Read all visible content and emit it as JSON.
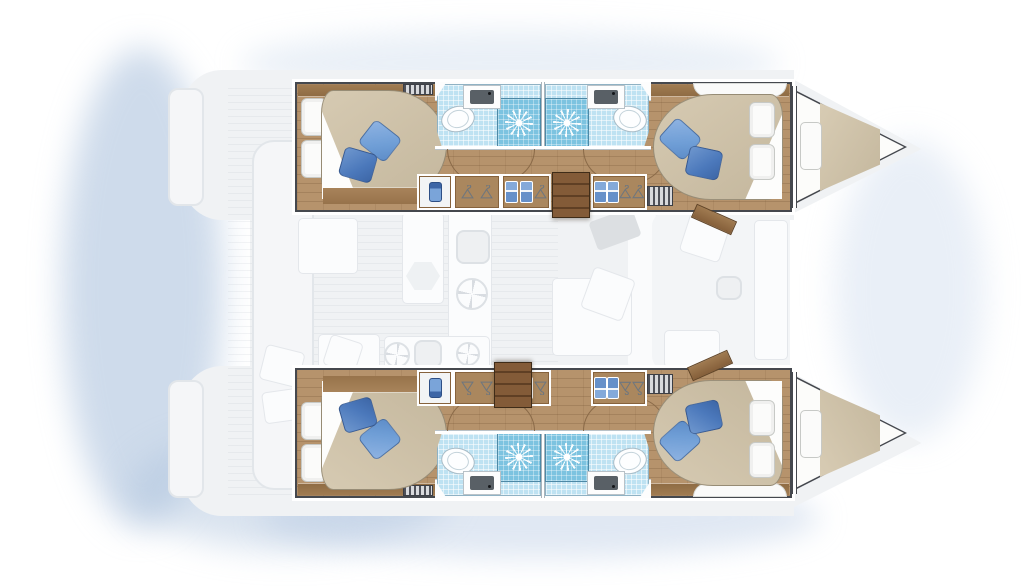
{
  "meta": {
    "title": "Catamaran floor plan — top view",
    "description": "Top-view interior layout plan of a sailing catamaran: four double cabins with en-suite bathrooms in the two hulls, two bow berths, and a ghosted main-deck salon, galley and aft cockpit."
  },
  "palette": {
    "background": "#ffffff",
    "water_glow": "#b7cbe4",
    "ghost_deck": "#f0f2f4",
    "hull_outline": "#45484e",
    "wood_floor": "#b6936c",
    "wood_trim": "#97744c",
    "steps_wood": "#6f4b2b",
    "bed_duvet": "#cdc1a9",
    "pillow_white": "#fbfbfa",
    "pillow_blue_light": "#6f9ed6",
    "pillow_blue_dark": "#4b78bb",
    "bath_tile_floor": "#bee2f2",
    "shower_tile": "#7cc3e0",
    "fixture_white": "#fdfeff",
    "basin_grey": "#596066"
  },
  "vessel": {
    "label": "Catamaran interior floor plan, bow to the right",
    "hulls": [
      {
        "id": "port",
        "label": "Port hull — aft double cabin, two en-suite bathrooms, forward double cabin, bow berth"
      },
      {
        "id": "starboard",
        "label": "Starboard hull — aft double cabin, two en-suite bathrooms, forward double cabin, bow berth"
      }
    ],
    "rooms": {
      "aft_cabin": "Aft double cabin with island bed and blue cushions",
      "fwd_cabin": "Forward double cabin with island bed and blue cushions",
      "bathroom": "Bathroom with shower cubicle, washbasin and toilet",
      "wardrobe": "Wardrobe and locker units with hangers and towels",
      "bow_berth": "Bow (forepeak) berth with mattress and pillow",
      "salon": "Salon with galley, table and sofa (ghosted main-deck level)",
      "cockpit": "Aft cockpit with bench and table (ghosted main-deck level)",
      "steps": "Companionway steps from salon down into hull"
    },
    "icons": [
      "shower-rose-icon",
      "toilet-icon",
      "washbasin-icon",
      "hanger-icon",
      "towel-icon",
      "vent-grille-icon"
    ],
    "counts": {
      "double_cabins": 4,
      "bathrooms": 4,
      "showers": 4,
      "bow_berths": 2
    }
  }
}
